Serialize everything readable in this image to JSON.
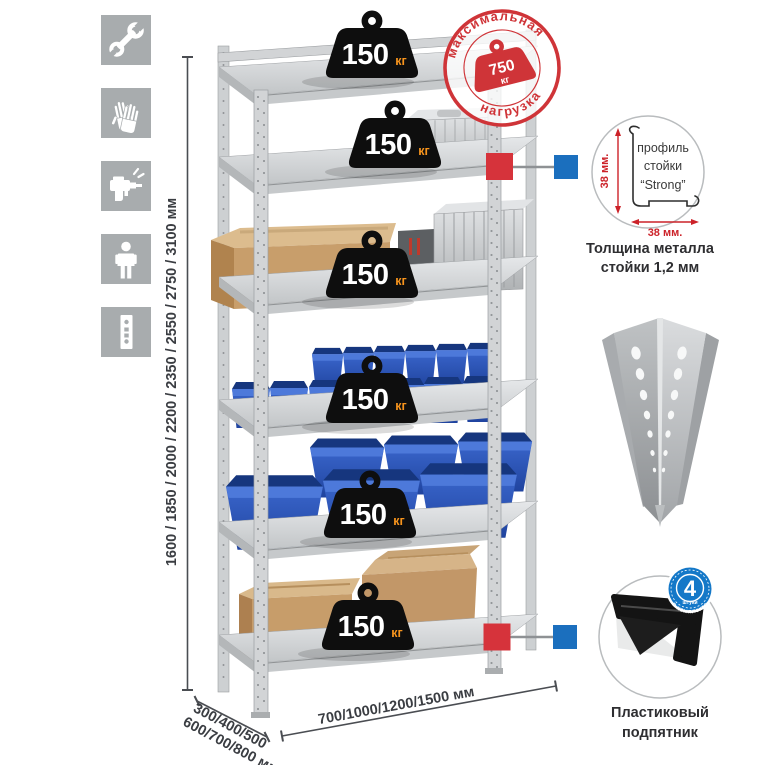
{
  "assembly_icons": {
    "tile_color": "#a8acae",
    "items": [
      {
        "icon": "wrench"
      },
      {
        "icon": "gloves"
      },
      {
        "icon": "drill"
      },
      {
        "icon": "person"
      },
      {
        "icon": "perforated-post"
      }
    ]
  },
  "dimensions": {
    "height_label": "1600 / 1850 / 2000 / 2200 / 2350 / 2550 / 2750 / 3100 мм",
    "depth_label_line1": "300/400/500",
    "depth_label_line2": "600/700/800 мм",
    "width_label": "700/1000/1200/1500 мм"
  },
  "weight_badge": {
    "value": "150",
    "unit": "кг",
    "unit_color": "#f7941d",
    "count": 6
  },
  "max_load_stamp": {
    "arc_top": "максимальная",
    "arc_bottom": "нагрузка",
    "value": "750",
    "unit": "кг",
    "color": "#cf3438"
  },
  "profile_callout": {
    "label_line1": "профиль",
    "label_line2": "стойки",
    "label_line3": "“Strong”",
    "vertical_dim": "38 мм.",
    "horizontal_dim": "38 мм.",
    "dim_color": "#cc2229",
    "caption_line1": "Толщина металла",
    "caption_line2": "стойки 1,2 мм"
  },
  "foot_callout": {
    "badge_value": "4",
    "badge_small_text": "штуки",
    "badge_arc_text": "в комплекте",
    "badge_color": "#1478c8",
    "caption_line1": "Пластиковый",
    "caption_line2": "подпятник"
  },
  "colors": {
    "metal_light": "#d6d8da",
    "metal_mid": "#c3c6c8",
    "metal_dark": "#9b9ea1",
    "bin_blue": "#2857bd",
    "cardboard": "#c79d6a",
    "weight_black": "#0e0e0e",
    "callout_red": "#d6333b",
    "callout_blue": "#1b6fbe",
    "dim_text": "#3a3d42"
  }
}
